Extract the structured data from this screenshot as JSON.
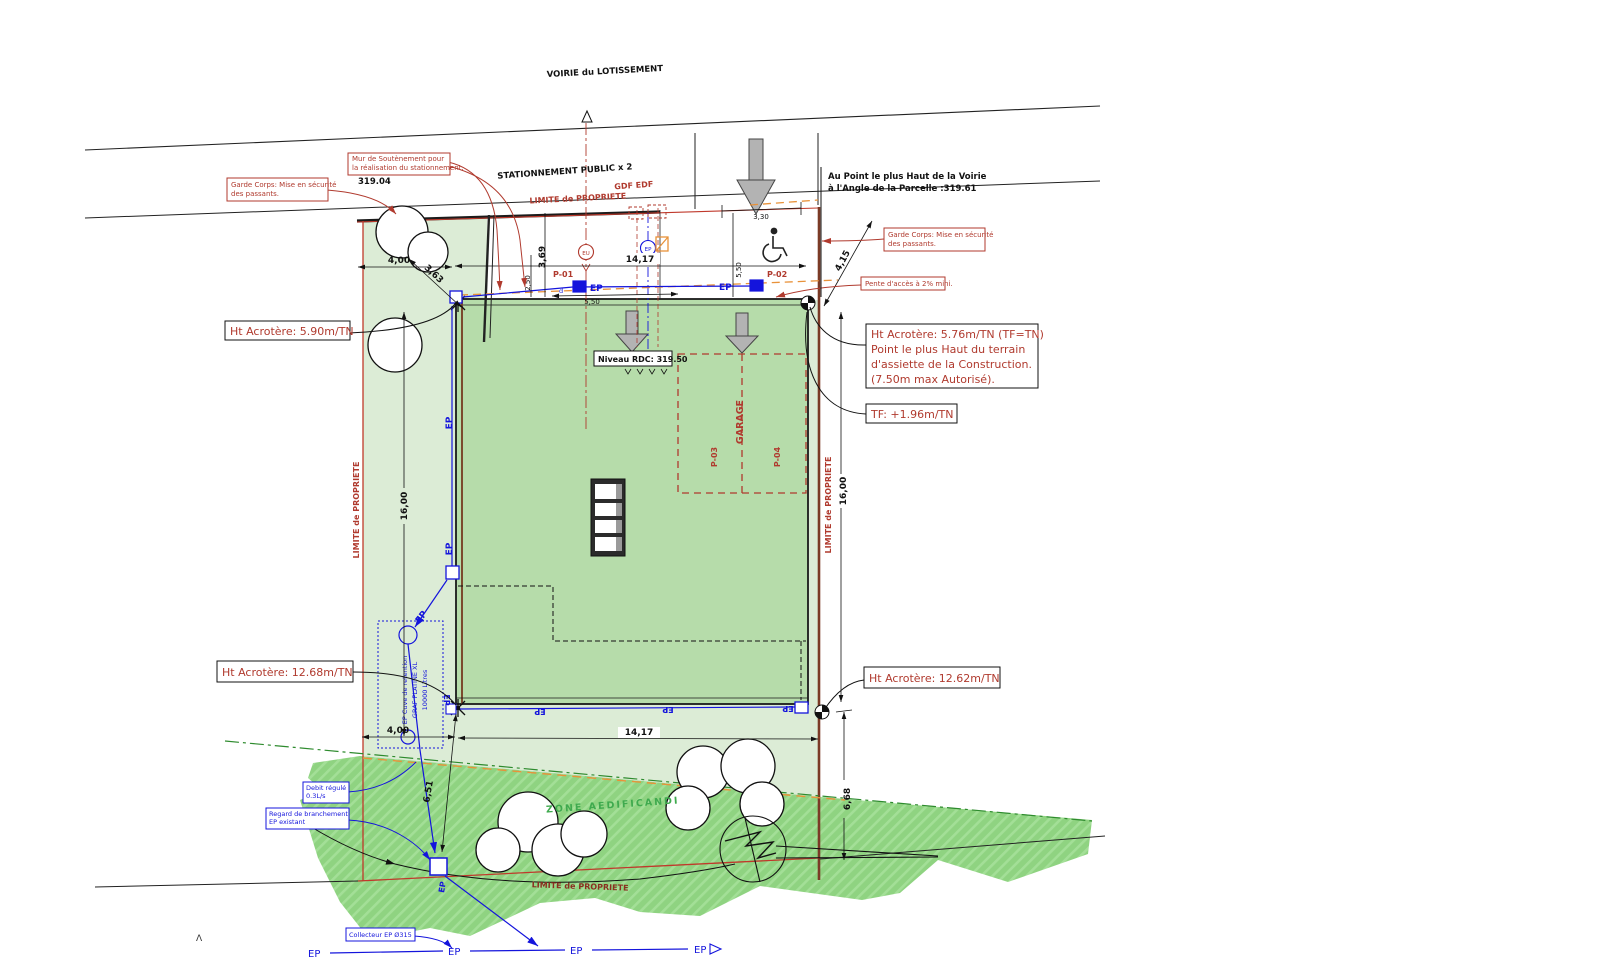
{
  "titles": {
    "voirie": "VOIRIE du LOTISSEMENT",
    "stationnement": "STATIONNEMENT PUBLIC x 2",
    "zone_aedificandi": "ZONE AEDIFICANDI"
  },
  "labels": {
    "limite_propriete": "LIMITE de PROPRIETE",
    "gdf_edf": "GDF EDF",
    "garage": "GARAGE",
    "p01": "P-01",
    "p02": "P-02",
    "p03": "P-03",
    "p04": "P-04",
    "ep": "EP",
    "eu": "EU",
    "d_valve": "d",
    "caret": "Λ",
    "level_319_04": "319.04"
  },
  "annotations": {
    "au_point_l1": "Au Point le plus Haut de la Voirie",
    "au_point_l2": "à l'Angle de la Parcelle :319.61",
    "mur_l1": "Mur de Soutènement pour",
    "mur_l2": "la réalisation du stationnement.",
    "garde_l1": "Garde Corps: Mise en sécurité",
    "garde_l2": "des passants.",
    "pente": "Pente d'accès à 2% mini.",
    "niveau_rdc": "Niveau RDC: 319.50",
    "acro_590": "Ht Acrotère: 5.90m/TN",
    "acro_576_l1": "Ht Acrotère: 5.76m/TN (TF=TN)",
    "acro_576_l2": "Point le plus Haut du terrain",
    "acro_576_l3": "d'assiette de la Construction.",
    "acro_576_l4": "(7.50m max Autorisé).",
    "tf": "TF: +1.96m/TN",
    "acro_1268": "Ht Acrotère: 12.68m/TN",
    "acro_1262": "Ht Acrotère: 12.62m/TN",
    "debit_l1": "Debit régulé",
    "debit_l2": "0.3L/s",
    "regard_l1": "Regard de branchement",
    "regard_l2": "EP existant",
    "collecteur": "Collecteur EP Ø315",
    "cuve_l1": "EP Cuve de retention",
    "cuve_l2": "GRAF PLATINE XL",
    "cuve_l3": "10000 Litres"
  },
  "dimensions": {
    "d400_top": "4,00",
    "d363": "3,63",
    "d369": "3,69",
    "d250": "2,50",
    "d1417_top": "14,17",
    "d550_top": "5,50",
    "d550_v": "5,50",
    "d330": "3,30",
    "d415": "4,15",
    "d1600_left": "16,00",
    "d1600_right": "16,00",
    "d400_bot": "4,00",
    "d1417_bot": "14,17",
    "d651": "6,51",
    "d668": "6,68"
  },
  "colors": {
    "annotation_red": "#b03a2e",
    "ep_blue": "#1414dc",
    "zone_green": "#3faa4e",
    "parcel_fill": "#dcecd6",
    "building_fill": "#b6dcaa",
    "zone_fill": "#8fd381",
    "boundary_orange": "#e8923a"
  }
}
